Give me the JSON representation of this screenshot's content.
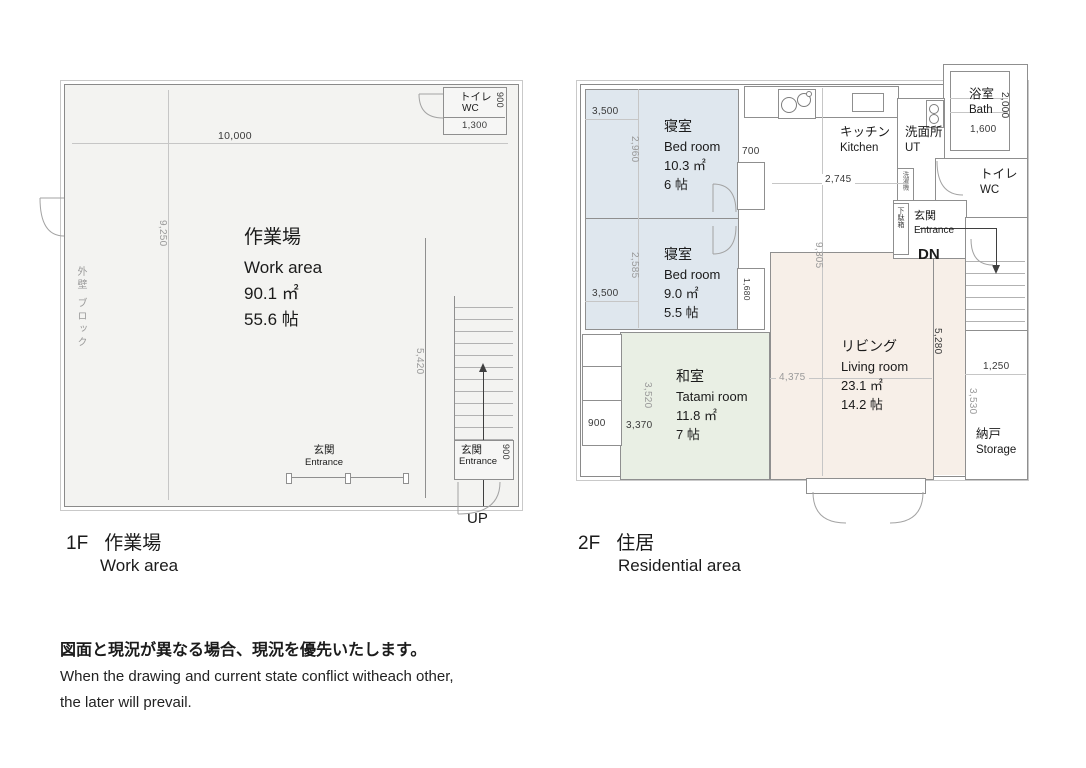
{
  "plan_1f": {
    "caption_floor": "1F",
    "caption_jp": "作業場",
    "caption_en": "Work area",
    "room_jp": "作業場",
    "room_en": "Work area",
    "room_sqm": "90.1 ㎡",
    "room_jyo": "55.6 帖",
    "wc_jp": "トイレ",
    "wc_en": "WC",
    "wc_dim_w": "1,300",
    "wc_dim_h": "900",
    "dim_width": "10,000",
    "dim_height": "9,250",
    "dim_stair": "5,420",
    "wall_note": "外壁 ブロック",
    "entrance_jp": "玄関",
    "entrance_en": "Entrance",
    "entrance2_jp": "玄関",
    "entrance2_en": "Entrance",
    "entrance2_dim": "900",
    "up": "UP"
  },
  "plan_2f": {
    "caption_floor": "2F",
    "caption_jp": "住居",
    "caption_en": "Residential area",
    "bedroom1": {
      "jp": "寝室",
      "en": "Bed room",
      "sqm": "10.3 ㎡",
      "jyo": "6 帖",
      "dim_w": "3,500",
      "dim_h": "2,960"
    },
    "bedroom2": {
      "jp": "寝室",
      "en": "Bed room",
      "sqm": "9.0 ㎡",
      "jyo": "5.5 帖",
      "dim_w": "3,500",
      "dim_h": "2,585"
    },
    "tatami": {
      "jp": "和室",
      "en": "Tatami room",
      "sqm": "11.8 ㎡",
      "jyo": "7 帖",
      "dim_a": "900",
      "dim_b": "3,370",
      "dim_h": "3,520"
    },
    "living": {
      "jp": "リビング",
      "en": "Living room",
      "sqm": "23.1 ㎡",
      "jyo": "14.2 帖",
      "dim_w": "4,375",
      "dim_h": "5,280",
      "dim_total": "9,305"
    },
    "kitchen": {
      "jp": "キッチン",
      "en": "Kitchen",
      "dim": "2,745",
      "dim_side": "700"
    },
    "ut": {
      "jp": "洗面所",
      "en": "UT",
      "washer": "洗濯機"
    },
    "bath": {
      "jp": "浴室",
      "en": "Bath",
      "dim_h": "2,000",
      "dim_w": "1,600"
    },
    "wc": {
      "jp": "トイレ",
      "en": "WC"
    },
    "entrance": {
      "jp": "玄関",
      "en": "Entrance",
      "shoe": "下駄箱"
    },
    "closet_dim": "1,680",
    "storage": {
      "jp": "納戸",
      "en": "Storage",
      "dim_w": "1,250",
      "dim_h": "3,530"
    },
    "dn": "DN"
  },
  "disclaimer": {
    "jp": "図面と現況が異なる場合、現況を優先いたします。",
    "en1": "When the drawing and current state conflict witheach other,",
    "en2": "the later will prevail."
  }
}
